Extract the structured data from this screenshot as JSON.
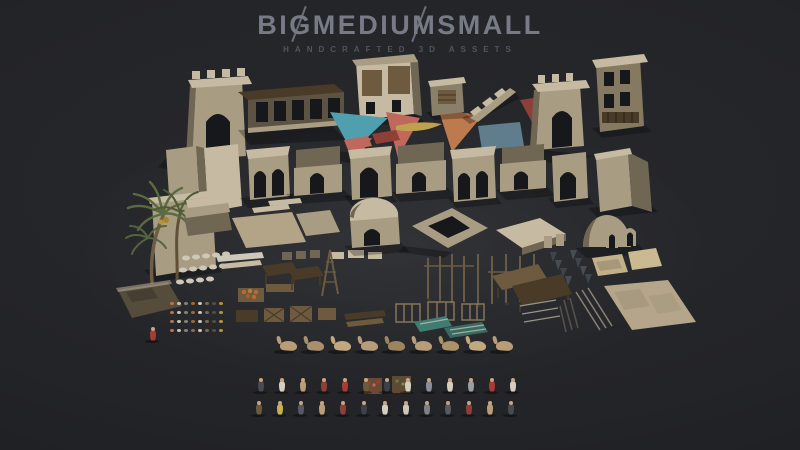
{
  "brand": {
    "logo": "BIGMEDIUMSMALL",
    "tagline": "HANDCRAFTED 3D ASSETS"
  },
  "colors": {
    "background": "#28292d",
    "background_edge": "#1b1c1f",
    "logo_text": "#767b86",
    "tagline_text": "#50545e",
    "stone": "#a89c83",
    "stone_light": "#c6bba2",
    "stone_dark": "#6f6753",
    "wood": "#6e5a3e",
    "wood_dark": "#4a3b28",
    "sail_teal": "#4f9fae",
    "sail_red": "#c0685c",
    "sail_orange": "#bd7a4f",
    "sail_maroon": "#8e4038",
    "cloth_blue": "#5f7d8c",
    "palm_green": "#5a6b3f",
    "rug_tan": "#b3a488",
    "boat_yellow": "#bfa04e",
    "camel": "#b89d78"
  },
  "sprites": {
    "camels": {
      "kind": "camel",
      "count": 9,
      "x": 280,
      "y": 341,
      "dx": 27,
      "dy": 0,
      "palette": [
        "#b89d78",
        "#a8906c",
        "#c2a87f",
        "#b89d78",
        "#9c845f",
        "#b89d78",
        "#ab9268",
        "#c2a87f",
        "#b89d78"
      ]
    },
    "people_row_1": {
      "kind": "person",
      "count": 13,
      "x": 258,
      "y": 381,
      "dx": 21,
      "dy": 0,
      "palette": [
        "#474b55",
        "#d5cec0",
        "#b89d78",
        "#8e4038",
        "#a83c32",
        "#6b5a3f",
        "#3d414c",
        "#d5cec0",
        "#8a8e96",
        "#d5cec0",
        "#9a9da4",
        "#a83c32",
        "#d5cec0"
      ]
    },
    "people_row_2": {
      "kind": "person",
      "count": 13,
      "x": 256,
      "y": 404,
      "dx": 21,
      "dy": 0,
      "palette": [
        "#6b5a3f",
        "#c8b24e",
        "#565a64",
        "#b89d78",
        "#8e4038",
        "#3d414c",
        "#d5cec0",
        "#cfc8b8",
        "#7d8188",
        "#565a64",
        "#8e4038",
        "#b89d78",
        "#474b55"
      ]
    },
    "lone_figure": {
      "kind": "person",
      "count": 1,
      "x": 150,
      "y": 330,
      "dx": 0,
      "dy": 0,
      "palette": [
        "#a83c32"
      ]
    },
    "small_props": {
      "kind": "dot",
      "count": 32,
      "x": 170,
      "y": 302,
      "dx": 7,
      "dy": 9,
      "wrap": 8,
      "palette": [
        "#b87840",
        "#c9c2b2",
        "#8a8274",
        "#9c6a34",
        "#cfc8b8",
        "#7a6a50",
        "#57503f",
        "#b8933a"
      ]
    }
  }
}
